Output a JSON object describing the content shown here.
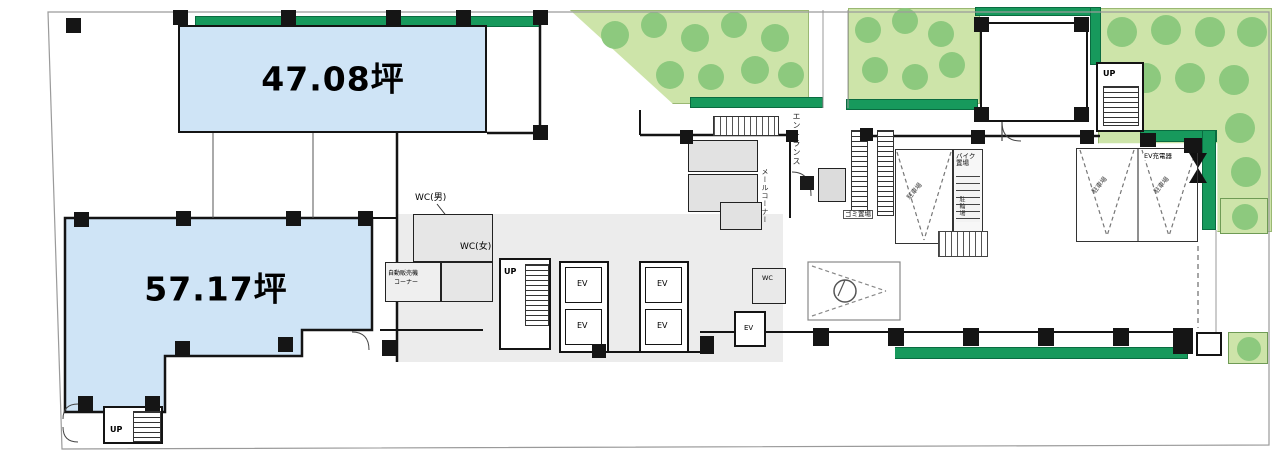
{
  "floorplan": {
    "units": [
      {
        "id": "unit-upper",
        "area_label": "47.08坪"
      },
      {
        "id": "unit-lower",
        "area_label": "57.17坪"
      }
    ],
    "labels": {
      "wc_male": "WC(男)",
      "wc_female": "WC(女)",
      "wc": "WC",
      "up": "UP",
      "ev": "EV",
      "entrance": "エントランス",
      "mail_corner": "メールコーナー",
      "vending_machine": "自動販売機",
      "vending_corner": "コーナー",
      "bike_parking": "バイク置場",
      "bicycle_parking": "駐輪場",
      "garbage_storage": "ゴミ置場",
      "car_parking": "駐車場",
      "ev_charger": "EV充電器"
    },
    "colors": {
      "unit_fill": "#cfe4f6",
      "wall": "#141414",
      "garden_fill": "#cde4a9",
      "tree_fill": "#8dc97e",
      "hedge_fill": "#17995c",
      "core_fill": "#ececec"
    }
  }
}
